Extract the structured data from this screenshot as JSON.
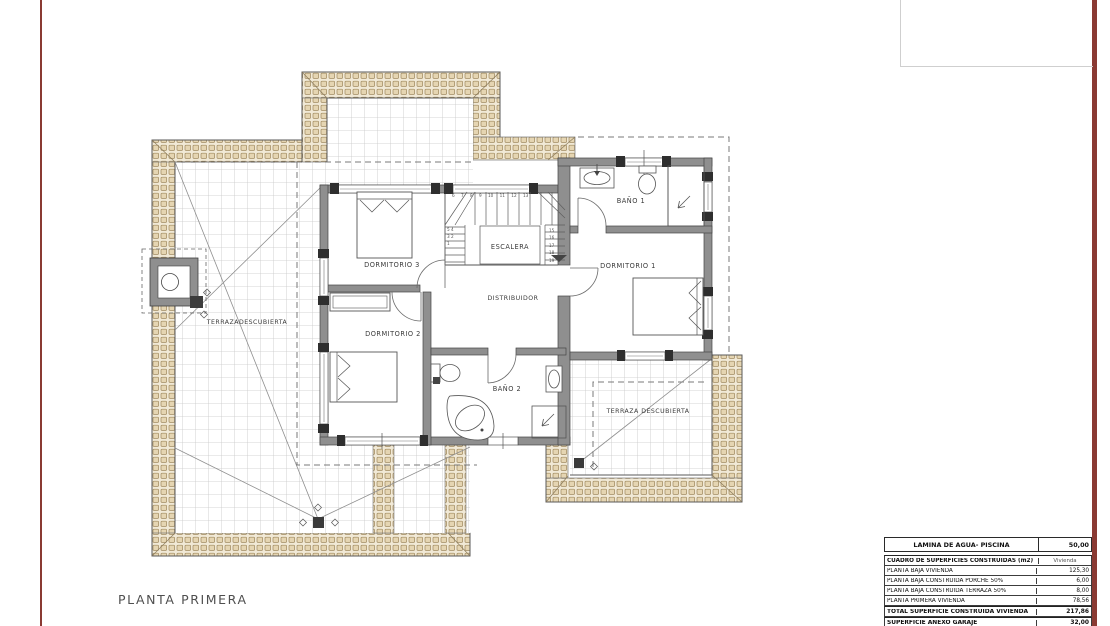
{
  "sheet": {
    "title": "PLANTA PRIMERA",
    "border_color": "#8a3a33",
    "paper_color": "#ffffff"
  },
  "plan": {
    "rooms": {
      "dormitorio1": "DORMITORIO 1",
      "dormitorio2": "DORMITORIO 2",
      "dormitorio3": "DORMITORIO 3",
      "bano1": "BAÑO 1",
      "bano2": "BAÑO 2",
      "escalera": "ESCALERA",
      "distribuidor": "DISTRIBUIDOR",
      "terraza_izquierda": "TERRAZADESCUBIERTA",
      "terraza_derecha": "TERRAZA DESCUBIERTA"
    },
    "stairs": {
      "top_numbers": "6 7 8 9 10 11 12 13",
      "left_numbers": "5 4 3 2 1",
      "right_numbers": "15 16 17 18 19"
    },
    "materials": {
      "roof_tile_fill": "#e5d5b2",
      "roof_tile_line": "#a0895f",
      "tile_background": "#f1e9d6",
      "grid_line": "#c7c7c7",
      "wall_fill": "#8f8f8f",
      "line_color": "#4a4a4a"
    }
  },
  "summary_table": {
    "rows": [
      {
        "label": "LAMINA DE AGUA- PISCINA",
        "value": "50,00"
      },
      {
        "label": "CUADRO DE SUPERFICIES CONSTRUIDAS (m2)",
        "value": "Vivienda"
      },
      {
        "label": "PLANTA BAJA VIVIENDA",
        "value": "125,30"
      },
      {
        "label": "PLANTA BAJA CONSTRUIDA PORCHE 50%",
        "value": "6,00"
      },
      {
        "label": "PLANTA BAJA CONSTRUIDA TERRAZA 50%",
        "value": "8,00"
      },
      {
        "label": "PLANTA PRIMERA VIVIENDA",
        "value": "78,56"
      },
      {
        "label": "TOTAL SUPERFICIE CONSTRUIDA VIVIENDA",
        "value": "217,86"
      },
      {
        "label": "SUPERFICIE ANEXO GARAJE",
        "value": "32,00"
      },
      {
        "label": "SUPERFICIE ANEXO BARBACOA",
        "value": "15,00"
      }
    ]
  }
}
